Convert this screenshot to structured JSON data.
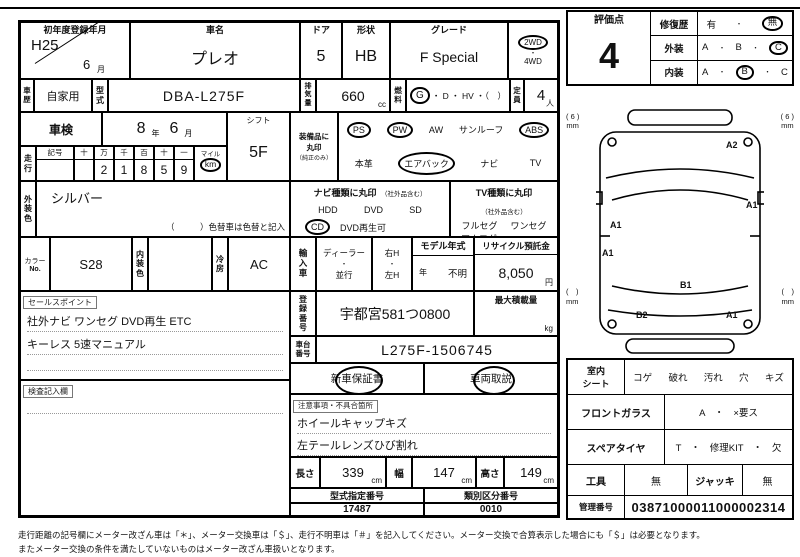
{
  "h1": {
    "regdate_label": "初年度登録年月",
    "era": "H25",
    "month": "6",
    "tsuki": "月",
    "carname_label": "車名",
    "carname": "プレオ",
    "doors_label": "ドア",
    "doors": "5",
    "shape_label": "形状",
    "shape": "HB",
    "grade_label": "グレード",
    "grade": "F Special",
    "drive_2wd": "2WD",
    "dot": "・",
    "drive_4wd": "4WD"
  },
  "h2": {
    "hist_label": "車歴",
    "hist": "自家用",
    "model_label": "型式",
    "model": "DBA-L275F",
    "disp_label": "排気量",
    "disp": "660",
    "cc": "cc",
    "fuel_label": "燃料",
    "fuel_g": "G",
    "fuel_rest": "・ D ・ HV ・（　）",
    "cap_label": "定員",
    "cap": "4",
    "nin": "人"
  },
  "left": {
    "shaken_label": "車検",
    "shaken_y": "8",
    "nen": "年",
    "shaken_m": "6",
    "tsuki": "月",
    "shift_label": "シフト",
    "shift": "5F",
    "run_label": "走行",
    "sym": "記号",
    "mh": [
      "十",
      "万",
      "千",
      "百",
      "十",
      "一"
    ],
    "md": [
      "",
      "2",
      "1",
      "8",
      "5",
      "9"
    ],
    "mile": "マイル",
    "km": "km",
    "ext_label": "外装色",
    "ext": "シルバー",
    "ext_note": "（　　　）色替車は色替と記入",
    "cno_label1": "カラー",
    "cno_label2": "No.",
    "cno": "S28",
    "int_label": "内装色",
    "int_val": "",
    "ac_label": "冷房",
    "ac": "AC",
    "sales_label": "セールスポイント",
    "sales1": "社外ナビ ワンセグ DVD再生 ETC",
    "sales2": "キーレス 5速マニュアル",
    "kensa_label": "検査記入欄"
  },
  "equip": {
    "l1": "装備品に",
    "l2": "丸印",
    "l3": "（純正のみ）",
    "ps": "PS",
    "pw": "PW",
    "aw": "AW",
    "sunroof": "サンルーフ",
    "abs": "ABS",
    "leather": "本革",
    "airbag": "エアバック",
    "navi": "ナビ",
    "tv": "TV"
  },
  "nav": {
    "title": "ナビ種類に丸印",
    "note": "（社外品含む）",
    "hdd": "HDD",
    "dvd": "DVD",
    "sd": "SD",
    "cd": "CD",
    "dvdplay": "DVD再生可"
  },
  "tvsec": {
    "title": "TV種類に丸印",
    "note": "（社外品含む）",
    "full": "フルセグ",
    "one": "ワンセグ",
    "analog": "アナログ"
  },
  "mid": {
    "import_label": "輸入車",
    "dealer": "ディーラー",
    "dot": "・",
    "parallel": "並行",
    "rh": "右H",
    "lh": "左H",
    "my_label": "モデル年式",
    "my_nen": "年",
    "my_val": "不明",
    "recycle_label": "リサイクル預託金",
    "recycle": "8,050",
    "yen": "円",
    "regno_label": "登録番号",
    "regno": "宇都宮581つ0800",
    "maxload_label": "最大積載量",
    "kg": "kg",
    "chassis_label": "車台番号",
    "chassis": "L275F-1506745",
    "warranty": "新車保証書",
    "manual": "車両取説",
    "notes_label": "注意事項・不具合箇所",
    "note1": "ホイールキャップキズ",
    "note2": "左テールレンズひび割れ",
    "len_label": "長さ",
    "len": "339",
    "cm": "cm",
    "wid_label": "幅",
    "wid": "147",
    "hei_label": "高さ",
    "hei": "149",
    "typeno_label": "型式指定番号",
    "typeno": "17487",
    "classno_label": "類別区分番号",
    "classno": "0010"
  },
  "score": {
    "label": "評価点",
    "value": "4",
    "repair": "修復歴",
    "yes": "有",
    "no": "無",
    "ext": "外装",
    "int": "内装",
    "a": "A",
    "b": "B",
    "c": "C",
    "dot": "・"
  },
  "diagram": {
    "mm": "mm",
    "tl": "( 6 )",
    "tr": "( 6 )",
    "bl": "(　)",
    "br": "(　)",
    "z1": "A2",
    "z2": "A1",
    "z3": "A1",
    "z4": "A1",
    "z5": "B1",
    "z6": "B2",
    "z7": "A1"
  },
  "cond": {
    "seat1": "室内",
    "seat2": "シート",
    "seat_opts": [
      "コゲ",
      "破れ",
      "汚れ",
      "穴",
      "キズ"
    ],
    "glass": "フロントガラス",
    "glass_val": "A　・　×要ス",
    "spare": "スペアタイヤ",
    "spare_val": "T　・　修理KIT　・　欠",
    "tool": "工具",
    "tool_val": "無",
    "jack": "ジャッキ",
    "jack_val": "無",
    "mgmt": "管理番号",
    "mgmt_val": "03871000011000002314"
  },
  "footer": {
    "l1": "走行距離の記号欄にメーター改ざん車は「＊」、メーター交換車は「＄」、走行不明車は「＃」を記入してください。メーター交換で合算表示した場合にも「＄」は必要となります。",
    "l2": "またメーター交換の条件を満たしていないものはメーター改ざん車扱いとなります。"
  }
}
